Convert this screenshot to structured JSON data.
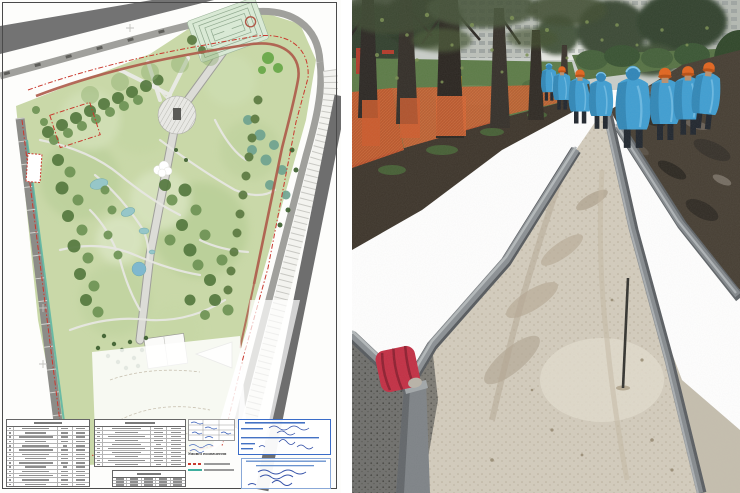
{
  "window": {
    "width": 740,
    "height": 493
  },
  "panels": {
    "left": {
      "name": "park-landscaping-master-plan-sheet"
    },
    "right": {
      "name": "park-pathway-construction-photo"
    }
  },
  "plan": {
    "legend": {
      "title": "Умовні позначення",
      "items": [
        {
          "style": "red-dash-dot-line",
          "color": "#c9392e"
        },
        {
          "style": "teal-solid-line",
          "color": "#3fae9e"
        }
      ]
    },
    "tables": {
      "explication_left": {
        "rows": 14,
        "columns": 4
      },
      "explication_right": {
        "rows": 10,
        "columns": 4
      },
      "indicators": {
        "rows": 3,
        "columns": 5
      }
    },
    "stamps": {
      "count": 3,
      "ink_color": "#2b54b4"
    }
  },
  "photo": {
    "scene": {
      "workers_count": 8,
      "elements": [
        "tree-trunks",
        "orange-protection-netting",
        "concrete-curbs",
        "sand-base-path",
        "mud-field",
        "blue-rain-ponchos",
        "orange-hard-hats",
        "apartment-buildings",
        "red-marker-on-curb",
        "survey-rod",
        "playground-equipment",
        "hedge-row",
        "gravel"
      ]
    },
    "palette": {
      "sand": "#d3ccbd",
      "mud": "#463e33",
      "curb": "#8b9094",
      "poncho_blue": "#3f9ed2",
      "helmet_orange": "#e2651f",
      "netting_orange": "#cc5a2c",
      "grass": "#5c7b47",
      "trunk": "#2c2824"
    }
  }
}
